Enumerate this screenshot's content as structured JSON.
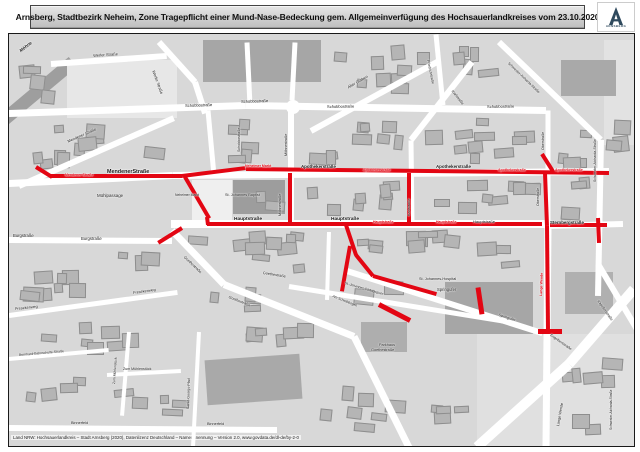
{
  "title": {
    "text": "Arnsberg, Stadtbezirk Neheim, Zone Tragepflicht einer Mund-Nase-Bedeckung gem. Allgemeinverfügung des Hochsauerlandkreises vom 23.10.2020"
  },
  "logo": {
    "caption": "ARNSBERG"
  },
  "scale": {
    "text": "M. 1 : 2.000"
  },
  "north": {
    "text": "N"
  },
  "attribution": {
    "text": "Land NRW: Hochsauerlandkreis – Stadt Arnsberg (2020), Datenlizenz Deutschland – Namensnennung – Version 2.0, www.govdata.de/dl-de/by-2-0"
  },
  "colors": {
    "zone_red": "#e30613",
    "map_bg": "#d8d8d8",
    "street": "#ffffff",
    "building": "#b5b5b5",
    "title_bg": "#c9c9c9",
    "logo_blue": "#2f4a5e"
  },
  "map": {
    "areas": [
      {
        "x": -20,
        "y": 52,
        "w": 95,
        "h": 13,
        "rot": -40,
        "c": "#9e9e9e"
      },
      {
        "x": 58,
        "y": 26,
        "w": 110,
        "h": 58,
        "rot": 0,
        "c": "#e7e7e7"
      },
      {
        "x": 595,
        "y": 6,
        "w": 32,
        "h": 105,
        "rot": 0,
        "c": "#e2e2e2"
      },
      {
        "x": 468,
        "y": 300,
        "w": 160,
        "h": 115,
        "rot": 0,
        "c": "#e0e0e0"
      },
      {
        "x": 194,
        "y": 6,
        "w": 118,
        "h": 42,
        "rot": 0,
        "c": "#a6a6a6"
      },
      {
        "x": 552,
        "y": 26,
        "w": 55,
        "h": 36,
        "rot": 0,
        "c": "#a9a9a9"
      },
      {
        "x": 183,
        "y": 146,
        "w": 40,
        "h": 40,
        "rot": 0,
        "c": "#efefef"
      },
      {
        "x": 224,
        "y": 146,
        "w": 52,
        "h": 34,
        "rot": 0,
        "c": "#9d9d9d"
      },
      {
        "x": 436,
        "y": 248,
        "w": 88,
        "h": 52,
        "rot": 0,
        "c": "#a6a6a6"
      },
      {
        "x": 352,
        "y": 288,
        "w": 46,
        "h": 30,
        "rot": 0,
        "c": "#aeaeae"
      },
      {
        "x": 197,
        "y": 323,
        "w": 95,
        "h": 45,
        "rot": -4,
        "c": "#a9a9a9"
      },
      {
        "x": 556,
        "y": 238,
        "w": 48,
        "h": 42,
        "rot": 0,
        "c": "#b0b0b0"
      },
      {
        "x": 277,
        "y": 66,
        "w": 14,
        "h": 14,
        "rot": 0,
        "c": "#ffffff",
        "round": 1
      }
    ],
    "streets": [
      {
        "x1": 0,
        "y1": 79,
        "x2": 237,
        "y2": 71,
        "w": 7
      },
      {
        "x1": 237,
        "y1": 71,
        "x2": 537,
        "y2": 76,
        "w": 7
      },
      {
        "x1": 0,
        "y1": 149,
        "x2": 164,
        "y2": 141,
        "w": 7
      },
      {
        "x1": 164,
        "y1": 141,
        "x2": 600,
        "y2": 137,
        "w": 7
      },
      {
        "x1": 162,
        "y1": 190,
        "x2": 540,
        "y2": 190,
        "w": 8
      },
      {
        "x1": 0,
        "y1": 206,
        "x2": 163,
        "y2": 207,
        "w": 6
      },
      {
        "x1": 537,
        "y1": 192,
        "x2": 614,
        "y2": 190,
        "w": 6
      },
      {
        "x1": 10,
        "y1": 152,
        "x2": 165,
        "y2": 84,
        "w": 6
      },
      {
        "x1": 42,
        "y1": 30,
        "x2": 158,
        "y2": 22,
        "w": 6
      },
      {
        "x1": 150,
        "y1": 8,
        "x2": 186,
        "y2": 48,
        "w": 6
      },
      {
        "x1": 186,
        "y1": 48,
        "x2": 196,
        "y2": 79,
        "w": 6
      },
      {
        "x1": 199,
        "y1": 76,
        "x2": 205,
        "y2": 141,
        "w": 5
      },
      {
        "x1": 282,
        "y1": 76,
        "x2": 282,
        "y2": 190,
        "w": 6
      },
      {
        "x1": 286,
        "y1": 8,
        "x2": 283,
        "y2": 66,
        "w": 5
      },
      {
        "x1": 302,
        "y1": 97,
        "x2": 428,
        "y2": 28,
        "w": 6
      },
      {
        "x1": 427,
        "y1": 0,
        "x2": 434,
        "y2": 71,
        "w": 5
      },
      {
        "x1": 238,
        "y1": 8,
        "x2": 241,
        "y2": 71,
        "w": 5
      },
      {
        "x1": 463,
        "y1": 28,
        "x2": 402,
        "y2": 106,
        "w": 6
      },
      {
        "x1": 402,
        "y1": 106,
        "x2": 403,
        "y2": 190,
        "w": 5
      },
      {
        "x1": 490,
        "y1": 8,
        "x2": 592,
        "y2": 106,
        "w": 6
      },
      {
        "x1": 592,
        "y1": 106,
        "x2": 589,
        "y2": 262,
        "w": 6
      },
      {
        "x1": 589,
        "y1": 230,
        "x2": 632,
        "y2": 302,
        "w": 6
      },
      {
        "x1": 539,
        "y1": 76,
        "x2": 539,
        "y2": 192,
        "w": 5
      },
      {
        "x1": 539,
        "y1": 192,
        "x2": 537,
        "y2": 413,
        "w": 7
      },
      {
        "x1": 163,
        "y1": 196,
        "x2": 215,
        "y2": 250,
        "w": 7
      },
      {
        "x1": 215,
        "y1": 250,
        "x2": 345,
        "y2": 302,
        "w": 7
      },
      {
        "x1": 345,
        "y1": 302,
        "x2": 400,
        "y2": 413,
        "w": 7
      },
      {
        "x1": 280,
        "y1": 252,
        "x2": 497,
        "y2": 287,
        "w": 5
      },
      {
        "x1": 338,
        "y1": 237,
        "x2": 533,
        "y2": 299,
        "w": 6
      },
      {
        "x1": 0,
        "y1": 281,
        "x2": 168,
        "y2": 258,
        "w": 5
      },
      {
        "x1": 0,
        "y1": 325,
        "x2": 100,
        "y2": 316,
        "w": 4
      },
      {
        "x1": 98,
        "y1": 341,
        "x2": 172,
        "y2": 337,
        "w": 4
      },
      {
        "x1": 120,
        "y1": 298,
        "x2": 113,
        "y2": 382,
        "w": 4
      },
      {
        "x1": 0,
        "y1": 394,
        "x2": 268,
        "y2": 396,
        "w": 6
      },
      {
        "x1": 190,
        "y1": 298,
        "x2": 184,
        "y2": 413,
        "w": 4
      },
      {
        "x1": 468,
        "y1": 413,
        "x2": 560,
        "y2": 330,
        "w": 10
      },
      {
        "x1": 560,
        "y1": 330,
        "x2": 625,
        "y2": 255,
        "w": 10
      },
      {
        "x1": 320,
        "y1": 198,
        "x2": 318,
        "y2": 266,
        "w": 4
      }
    ],
    "zone_segments": [
      {
        "x1": 27,
        "y1": 133,
        "x2": 43,
        "y2": 143,
        "w": 4
      },
      {
        "x1": 41,
        "y1": 142,
        "x2": 173,
        "y2": 142,
        "w": 4
      },
      {
        "x1": 173,
        "y1": 142,
        "x2": 237,
        "y2": 134,
        "w": 4
      },
      {
        "x1": 237,
        "y1": 135,
        "x2": 600,
        "y2": 139,
        "w": 4
      },
      {
        "x1": 176,
        "y1": 143,
        "x2": 200,
        "y2": 184,
        "w": 4
      },
      {
        "x1": 198,
        "y1": 183,
        "x2": 199,
        "y2": 191,
        "w": 4
      },
      {
        "x1": 198,
        "y1": 190,
        "x2": 533,
        "y2": 190,
        "w": 4
      },
      {
        "x1": 173,
        "y1": 194,
        "x2": 149,
        "y2": 209,
        "w": 4
      },
      {
        "x1": 281,
        "y1": 139,
        "x2": 281,
        "y2": 189,
        "w": 4
      },
      {
        "x1": 400,
        "y1": 139,
        "x2": 400,
        "y2": 189,
        "w": 4
      },
      {
        "x1": 536,
        "y1": 139,
        "x2": 538,
        "y2": 192,
        "w": 4
      },
      {
        "x1": 538,
        "y1": 192,
        "x2": 539,
        "y2": 296,
        "w": 4
      },
      {
        "x1": 529,
        "y1": 297,
        "x2": 553,
        "y2": 297,
        "w": 5
      },
      {
        "x1": 533,
        "y1": 120,
        "x2": 545,
        "y2": 139,
        "w": 4
      },
      {
        "x1": 541,
        "y1": 191,
        "x2": 598,
        "y2": 191,
        "w": 4
      },
      {
        "x1": 589,
        "y1": 184,
        "x2": 590,
        "y2": 209,
        "w": 4
      },
      {
        "x1": 337,
        "y1": 191,
        "x2": 347,
        "y2": 221,
        "w": 4
      },
      {
        "x1": 347,
        "y1": 221,
        "x2": 364,
        "y2": 242,
        "w": 4
      },
      {
        "x1": 364,
        "y1": 242,
        "x2": 427,
        "y2": 260,
        "w": 4
      },
      {
        "x1": 469,
        "y1": 253,
        "x2": 473,
        "y2": 280,
        "w": 5
      },
      {
        "x1": 341,
        "y1": 212,
        "x2": 333,
        "y2": 257,
        "w": 4
      },
      {
        "x1": 370,
        "y1": 270,
        "x2": 401,
        "y2": 286,
        "w": 5
      }
    ],
    "labels": [
      {
        "t": "Möhne",
        "x": 10,
        "y": 16,
        "r": -38,
        "s": 4.5,
        "b": 1,
        "i": 1
      },
      {
        "t": "Werler Straße",
        "x": 84,
        "y": 20,
        "r": -4,
        "s": 4
      },
      {
        "t": "Werler Straße",
        "x": 146,
        "y": 36,
        "r": 70,
        "s": 4
      },
      {
        "t": "Schobbostraße",
        "x": 176,
        "y": 70,
        "r": -2,
        "s": 4
      },
      {
        "t": "Schobbostraße",
        "x": 232,
        "y": 66,
        "r": -2,
        "s": 4
      },
      {
        "t": "Schobbostraße",
        "x": 318,
        "y": 71,
        "r": -1,
        "s": 4
      },
      {
        "t": "Schobbostraße",
        "x": 478,
        "y": 71,
        "r": -1,
        "s": 4
      },
      {
        "t": "Schobbostraße",
        "x": 229,
        "y": 118,
        "r": -90,
        "s": 3.6
      },
      {
        "t": "Mendener Straße",
        "x": 58,
        "y": 106,
        "r": -24,
        "s": 4
      },
      {
        "t": "MendenerStraße",
        "x": 98,
        "y": 136,
        "r": 0,
        "s": 5.4,
        "b": 1
      },
      {
        "t": "Mühlpassage",
        "x": 88,
        "y": 160,
        "r": 0,
        "s": 4.4
      },
      {
        "t": "Neheimer Markt",
        "x": 166,
        "y": 160,
        "r": 0,
        "s": 3.4
      },
      {
        "t": "St. Johannes Baptist",
        "x": 216,
        "y": 160,
        "r": 0,
        "s": 3.8
      },
      {
        "t": "Möhnestraße",
        "x": 276,
        "y": 122,
        "r": -90,
        "s": 3.8
      },
      {
        "t": "Möhnestraße",
        "x": 270,
        "y": 182,
        "r": -90,
        "s": 3.8
      },
      {
        "t": "Burgstraße",
        "x": 4,
        "y": 200,
        "r": 0,
        "s": 4.2
      },
      {
        "t": "Burgstraße",
        "x": 72,
        "y": 203,
        "r": 0,
        "s": 4.2
      },
      {
        "t": "Alter Graben",
        "x": 338,
        "y": 52,
        "r": -30,
        "s": 4
      },
      {
        "t": "Friedrichstraße",
        "x": 420,
        "y": 26,
        "r": 78,
        "s": 3.6
      },
      {
        "t": "Karlstraße",
        "x": 444,
        "y": 56,
        "r": 52,
        "s": 3.8
      },
      {
        "t": "Karlstraße",
        "x": 399,
        "y": 182,
        "r": -90,
        "s": 3.8
      },
      {
        "t": "Apothekerstraße",
        "x": 292,
        "y": 131,
        "r": 0,
        "s": 4.4,
        "b": 1
      },
      {
        "t": "Apothekerstraße",
        "x": 427,
        "y": 131,
        "r": 0,
        "s": 4.4,
        "b": 1
      },
      {
        "t": "Oberstraße",
        "x": 533,
        "y": 116,
        "r": -90,
        "s": 3.6
      },
      {
        "t": "Oberstraße",
        "x": 528,
        "y": 172,
        "r": -90,
        "s": 3.6
      },
      {
        "t": "Schwester-Aicharda-Straße",
        "x": 500,
        "y": 28,
        "r": 44,
        "s": 3.5
      },
      {
        "t": "Schwester-Aicharda-Straße",
        "x": 585,
        "y": 148,
        "r": -90,
        "s": 3.5
      },
      {
        "t": "Schwester-Aicharda-Straße",
        "x": 601,
        "y": 396,
        "r": -90,
        "s": 3.3
      },
      {
        "t": "Hauptstraße",
        "x": 225,
        "y": 184,
        "r": 0,
        "s": 4.8,
        "b": 1
      },
      {
        "t": "Hauptstraße",
        "x": 322,
        "y": 184,
        "r": 0,
        "s": 4.8,
        "b": 1
      },
      {
        "t": "Hauptstraße",
        "x": 464,
        "y": 186,
        "r": 0,
        "s": 4
      },
      {
        "t": "Sternbergstraße",
        "x": 541,
        "y": 187,
        "r": 0,
        "s": 4.4,
        "b": 1
      },
      {
        "t": "Springufer",
        "x": 428,
        "y": 254,
        "r": 0,
        "s": 4.2
      },
      {
        "t": "Springufer",
        "x": 490,
        "y": 280,
        "r": 18,
        "s": 3.8
      },
      {
        "t": "St. Johannes-Hospital",
        "x": 410,
        "y": 244,
        "r": 0,
        "s": 3.8
      },
      {
        "t": "St.-Johannes-Pädagogium",
        "x": 336,
        "y": 248,
        "r": 16,
        "s": 3.4
      },
      {
        "t": "Am Schwibbogen",
        "x": 324,
        "y": 261,
        "r": 22,
        "s": 3.4
      },
      {
        "t": "Parkhaus",
        "x": 370,
        "y": 310,
        "r": 0,
        "s": 3.8
      },
      {
        "t": "Goethestraße",
        "x": 362,
        "y": 315,
        "r": 0,
        "s": 3.8
      },
      {
        "t": "Goethestraße",
        "x": 176,
        "y": 222,
        "r": 44,
        "s": 3.8
      },
      {
        "t": "Goethestraße",
        "x": 254,
        "y": 238,
        "r": 9,
        "s": 3.8
      },
      {
        "t": "Goethestraße",
        "x": 220,
        "y": 262,
        "r": 22,
        "s": 3.8
      },
      {
        "t": "Fresekenweg",
        "x": 6,
        "y": 274,
        "r": -6,
        "s": 3.8
      },
      {
        "t": "Fresekenweg",
        "x": 124,
        "y": 258,
        "r": -8,
        "s": 3.8
      },
      {
        "t": "Bernhard-Bahnschulte-Straße",
        "x": 10,
        "y": 320,
        "r": -5,
        "s": 3.4
      },
      {
        "t": "Zum Mühlenstück",
        "x": 114,
        "y": 334,
        "r": 0,
        "s": 3.6
      },
      {
        "t": "Zum Mühlenstück",
        "x": 104,
        "y": 350,
        "r": -86,
        "s": 3.4
      },
      {
        "t": "Binnerfeld",
        "x": 62,
        "y": 388,
        "r": 0,
        "s": 3.8
      },
      {
        "t": "Binnerfeld",
        "x": 198,
        "y": 389,
        "r": 0,
        "s": 3.8
      },
      {
        "t": "Sankt-Georgs-Pfad",
        "x": 178,
        "y": 375,
        "r": -88,
        "s": 3.6
      },
      {
        "t": "Kapellenstraße",
        "x": 590,
        "y": 266,
        "r": 55,
        "s": 3.6
      },
      {
        "t": "Engelbertstraße",
        "x": 542,
        "y": 300,
        "r": 35,
        "s": 3.6
      },
      {
        "t": "Lange Wende",
        "x": 548,
        "y": 392,
        "r": -80,
        "s": 3.8
      },
      {
        "t": "Mendener Straße",
        "x": 56,
        "y": 140,
        "r": 0,
        "s": 3.5,
        "b": 1,
        "c": "#e30613"
      },
      {
        "t": "Neheimer Markt",
        "x": 236,
        "y": 131,
        "r": 0,
        "s": 3.5,
        "b": 1,
        "c": "#e30613"
      },
      {
        "t": "Apothekerstraße",
        "x": 354,
        "y": 135,
        "r": 0,
        "s": 3.5,
        "b": 1,
        "c": "#e30613"
      },
      {
        "t": "Apothekerstraße",
        "x": 489,
        "y": 135,
        "r": 0,
        "s": 3.5,
        "b": 1,
        "c": "#e30613"
      },
      {
        "t": "Apothekerstraße",
        "x": 546,
        "y": 135,
        "r": 0,
        "s": 3.5,
        "b": 1,
        "c": "#e30613"
      },
      {
        "t": "Hauptstraße",
        "x": 364,
        "y": 187,
        "r": 0,
        "s": 3.5,
        "b": 1,
        "c": "#e30613"
      },
      {
        "t": "Hauptstraße",
        "x": 427,
        "y": 187,
        "r": 0,
        "s": 3.5,
        "b": 1,
        "c": "#e30613"
      },
      {
        "t": "Lange Wende",
        "x": 531,
        "y": 262,
        "r": -88,
        "s": 3.6,
        "b": 1,
        "c": "#e30613"
      }
    ],
    "blocks": [
      {
        "x": 8,
        "y": 88,
        "w": 150,
        "h": 48,
        "n": 10
      },
      {
        "x": 214,
        "y": 84,
        "w": 60,
        "h": 50,
        "n": 6
      },
      {
        "x": 296,
        "y": 84,
        "w": 100,
        "h": 50,
        "n": 9
      },
      {
        "x": 412,
        "y": 78,
        "w": 118,
        "h": 52,
        "n": 10
      },
      {
        "x": 545,
        "y": 84,
        "w": 45,
        "h": 52,
        "n": 4
      },
      {
        "x": 318,
        "y": 6,
        "w": 105,
        "h": 58,
        "n": 9
      },
      {
        "x": 434,
        "y": 8,
        "w": 64,
        "h": 44,
        "n": 5
      },
      {
        "x": 292,
        "y": 144,
        "w": 105,
        "h": 40,
        "n": 8
      },
      {
        "x": 412,
        "y": 144,
        "w": 120,
        "h": 40,
        "n": 9
      },
      {
        "x": 545,
        "y": 142,
        "w": 42,
        "h": 44,
        "n": 4
      },
      {
        "x": 175,
        "y": 196,
        "w": 150,
        "h": 44,
        "n": 10
      },
      {
        "x": 342,
        "y": 196,
        "w": 190,
        "h": 40,
        "n": 12
      },
      {
        "x": 16,
        "y": 216,
        "w": 140,
        "h": 52,
        "n": 9
      },
      {
        "x": 24,
        "y": 286,
        "w": 130,
        "h": 42,
        "n": 7
      },
      {
        "x": 96,
        "y": 346,
        "w": 84,
        "h": 38,
        "n": 5
      },
      {
        "x": 208,
        "y": 286,
        "w": 115,
        "h": 30,
        "n": 6
      },
      {
        "x": 300,
        "y": 330,
        "w": 110,
        "h": 70,
        "n": 7
      },
      {
        "x": 545,
        "y": 305,
        "w": 75,
        "h": 100,
        "n": 7
      },
      {
        "x": 410,
        "y": 330,
        "w": 55,
        "h": 60,
        "n": 4
      },
      {
        "x": 8,
        "y": 30,
        "w": 40,
        "h": 55,
        "n": 4
      },
      {
        "x": 596,
        "y": 84,
        "w": 28,
        "h": 50,
        "n": 3
      },
      {
        "x": 8,
        "y": 340,
        "w": 70,
        "h": 40,
        "n": 4
      },
      {
        "x": 8,
        "y": 246,
        "w": 40,
        "h": 30,
        "n": 2
      },
      {
        "x": 340,
        "y": 246,
        "w": 60,
        "h": 30,
        "n": 3
      },
      {
        "x": 196,
        "y": 250,
        "w": 60,
        "h": 40,
        "n": 4
      },
      {
        "x": 240,
        "y": 148,
        "w": 38,
        "h": 30,
        "n": 2
      }
    ]
  }
}
